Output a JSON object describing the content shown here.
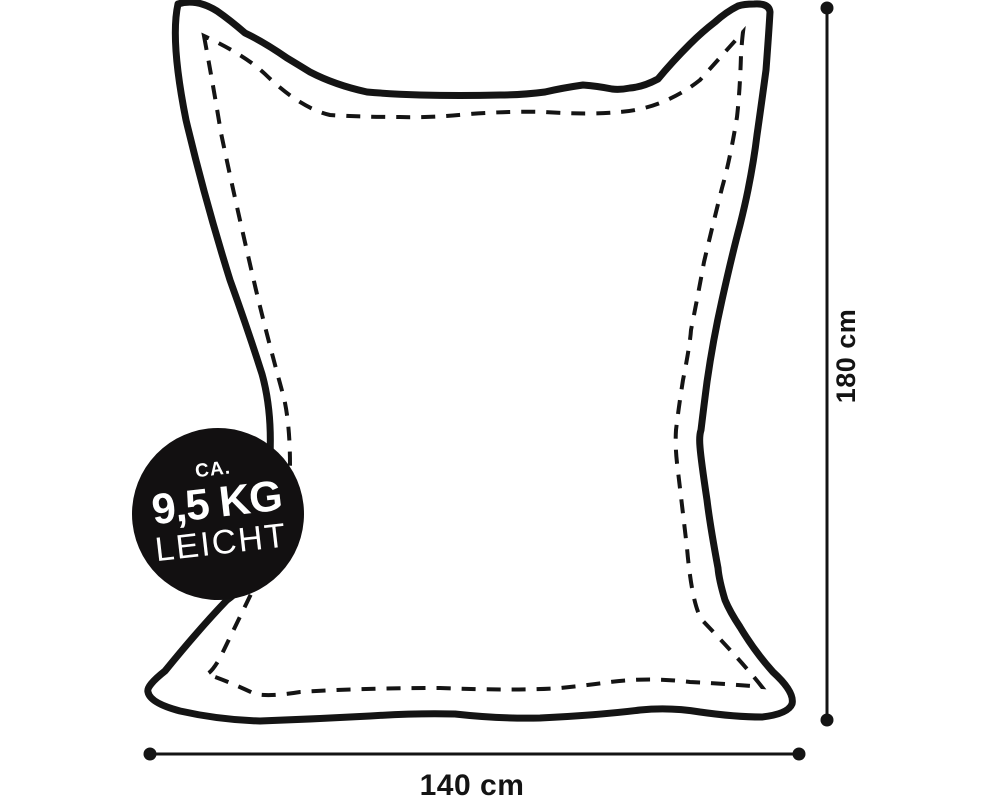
{
  "diagram": {
    "kind": "beanbag-size-diagram",
    "colors": {
      "line": "#141414",
      "badge_bg": "#121011",
      "badge_text": "#ffffff",
      "background": "#ffffff"
    },
    "weight_badge": {
      "line1": "CA.",
      "line2": "9,5 KG",
      "line3": "LEICHT"
    },
    "dimensions": {
      "height_label": "180 cm",
      "width_label": "140 cm"
    }
  }
}
